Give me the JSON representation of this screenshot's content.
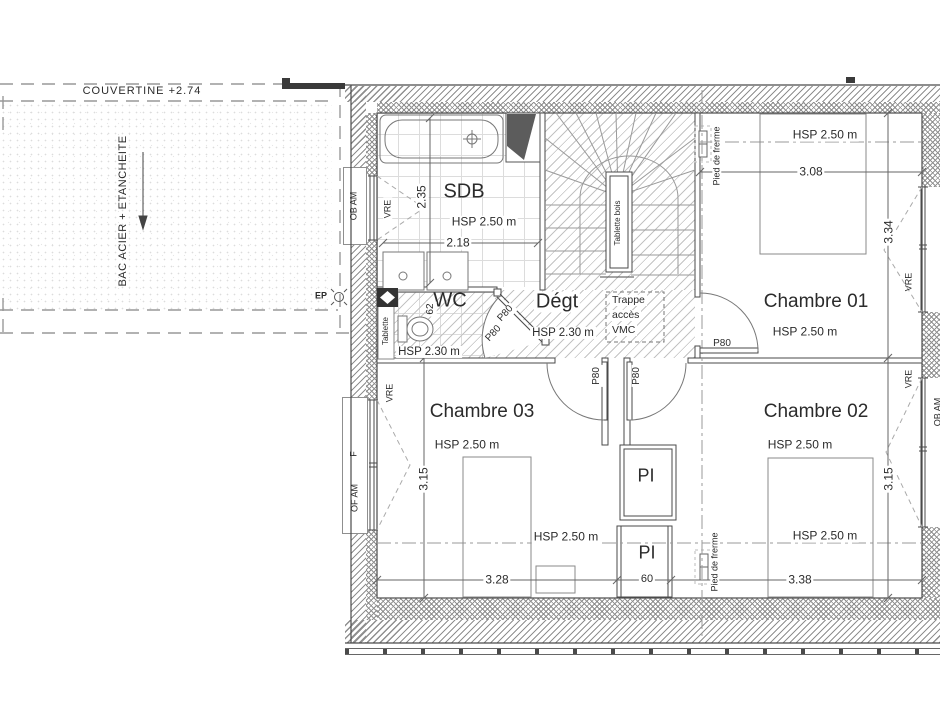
{
  "drawing_type": "architectural floor plan - upper storey",
  "roof": {
    "couvertine": "COUVERTINE +2.74",
    "material": "BAC ACIER + ETANCHEITE",
    "ep": "EP"
  },
  "sdb": {
    "name": "SDB",
    "hsp": "HSP 2.50 m",
    "width": "2.18",
    "depth": "2.35",
    "window": "OB AM",
    "vre": "VRE"
  },
  "wc": {
    "name": "WC",
    "hsp": "HSP 2.30 m",
    "dim": "62",
    "shelf": "Tablette",
    "door_a": "P80",
    "door_b": "P80"
  },
  "degt": {
    "name": "Dégt",
    "hsp": "HSP 2.30 m"
  },
  "trappe": {
    "line1": "Trappe",
    "line2": "accès",
    "line3": "VMC"
  },
  "stair": {
    "tablette": "Tablette bois"
  },
  "ch01": {
    "name": "Chambre 01",
    "hsp": "HSP 2.50 m",
    "bed_hsp": "HSP 2.50 m",
    "width": "3.08",
    "depth": "3.34",
    "door": "P80",
    "vre": "VRE",
    "pied": "Pied de frerme"
  },
  "ch02": {
    "name": "Chambre 02",
    "hsp": "HSP 2.50 m",
    "bed_hsp": "HSP 2.50 m",
    "width": "3.38",
    "depth": "3.15",
    "vre": "VRE",
    "pied": "Pied de frerme"
  },
  "ch03": {
    "name": "Chambre 03",
    "hsp": "HSP 2.50 m",
    "bed_hsp": "HSP 2.50 m",
    "width": "3.28",
    "depth": "3.15",
    "door": "P80",
    "door2": "P80",
    "vre": "VRE",
    "window_top": "F",
    "window_bottom": "OF AM"
  },
  "pi": {
    "upper": "PI",
    "lower": "PI",
    "width": "60"
  },
  "right_edge_label": "OB AM",
  "colors": {
    "line": "#4a4a4a",
    "hatch": "#8f8f8f",
    "floor_hatch": "#c3c3c3",
    "text": "#2b2b2b"
  }
}
